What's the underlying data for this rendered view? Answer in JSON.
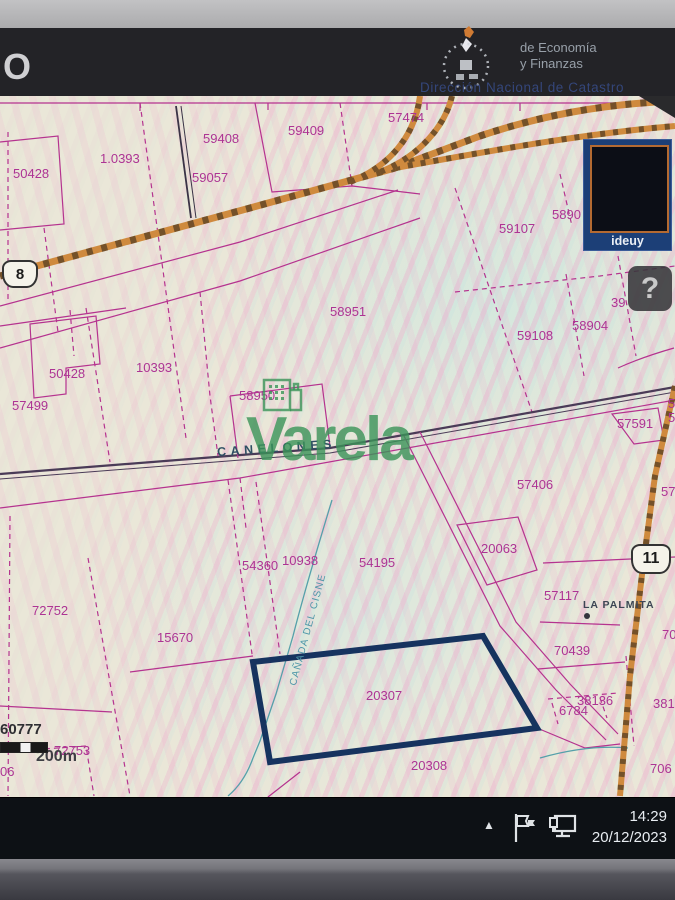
{
  "header": {
    "partial_title": "O",
    "ministry_line1": "de Economía",
    "ministry_line2": "y Finanzas",
    "subtitle": "Dirección Nacional de Catastro"
  },
  "map": {
    "labels": [
      {
        "text": "50428"
      },
      {
        "text": "1.0393"
      },
      {
        "text": "59408"
      },
      {
        "text": "59409"
      },
      {
        "text": "57474"
      },
      {
        "text": "59057"
      },
      {
        "text": "59107"
      },
      {
        "text": "5890"
      },
      {
        "text": "39"
      },
      {
        "text": "58951"
      },
      {
        "text": "59108"
      },
      {
        "text": "58904"
      },
      {
        "text": "10393"
      },
      {
        "text": "50428"
      },
      {
        "text": "57499"
      },
      {
        "text": "58950"
      },
      {
        "text": "57591"
      },
      {
        "text": "57406"
      },
      {
        "text": "20063"
      },
      {
        "text": "54360"
      },
      {
        "text": "10938"
      },
      {
        "text": "54195"
      },
      {
        "text": "57117"
      },
      {
        "text": "70439"
      },
      {
        "text": "38136"
      },
      {
        "text": "6784"
      },
      {
        "text": "72752"
      },
      {
        "text": "15670"
      },
      {
        "text": "20307"
      },
      {
        "text": "20308"
      },
      {
        "text": "72753"
      },
      {
        "text": "60777"
      },
      {
        "text": "06"
      },
      {
        "text": "5"
      },
      {
        "text": "5"
      },
      {
        "text": "57"
      },
      {
        "text": "70"
      },
      {
        "text": "381"
      },
      {
        "text": "706"
      }
    ],
    "scale_label": "200m",
    "place_canelones": "CANELONES",
    "place_la_palmita": "LA PALMITA",
    "stream_name": "CAÑADA DEL CISNE",
    "watermark": "Varela",
    "route_shield_8": "8",
    "route_shield_11": "11",
    "ideuy_label": "ideuy",
    "help_label": "?",
    "highlighted_parcel": "20307"
  },
  "taskbar": {
    "time": "14:29",
    "date": "20/12/2023"
  },
  "colors": {
    "parcel_line": "#b5338f",
    "road_orange": "#cf8a3e",
    "highlight_navy": "#16335f",
    "watermark_green": "#3f9e5f",
    "ideuy_blue": "#1c3f77"
  }
}
